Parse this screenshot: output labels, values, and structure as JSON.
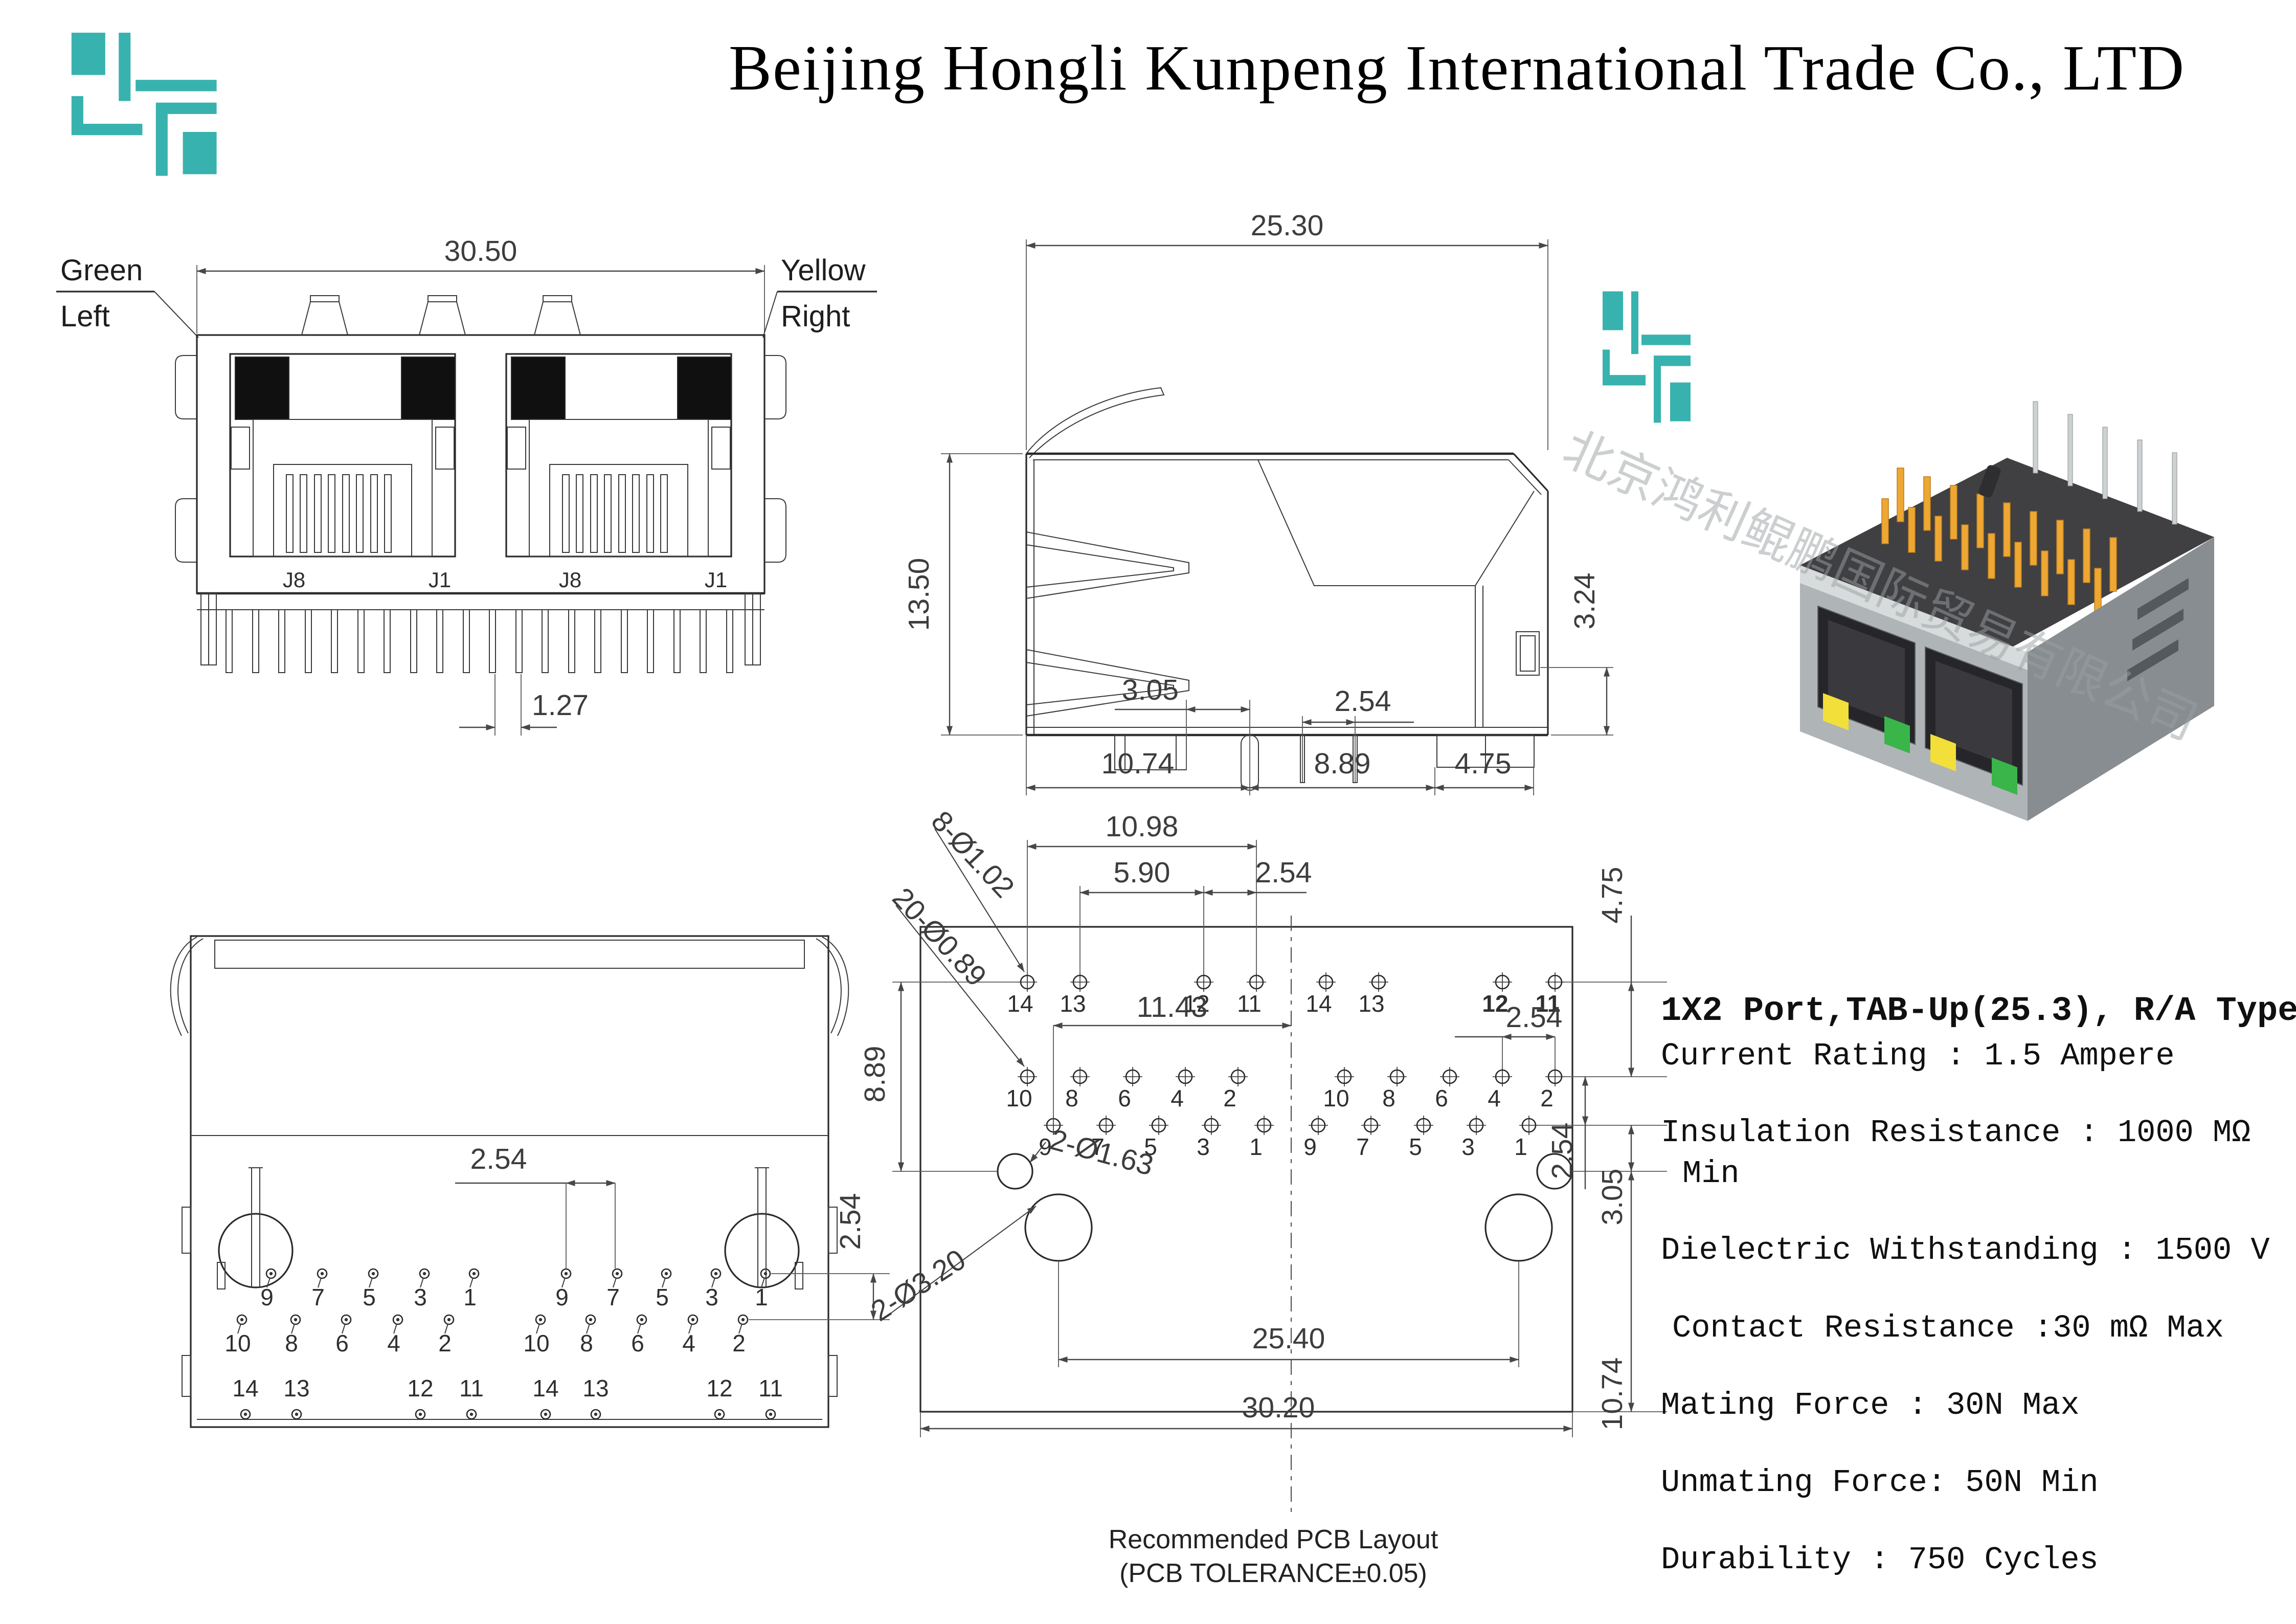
{
  "header": {
    "title": "Beijing Hongli Kunpeng International Trade Co., LTD"
  },
  "colors": {
    "brand_teal": "#38b2ae",
    "led_yellow": "#f2df3a",
    "led_green": "#3ab54a",
    "pin_gold": "#efa733"
  },
  "front_view": {
    "dim_width": "30.50",
    "dim_pitch": "1.27",
    "label_green": "Green",
    "label_left": "Left",
    "label_yellow": "Yellow",
    "label_right": "Right",
    "port_labels": [
      "J8",
      "J1",
      "J8",
      "J1"
    ]
  },
  "side_view": {
    "dim_width": "25.30",
    "dim_height": "13.50",
    "dim_tab": "3.24",
    "dim_305": "3.05",
    "dim_254": "2.54",
    "dim_1074": "10.74",
    "dim_889": "8.89",
    "dim_475": "4.75"
  },
  "bottom_view": {
    "dim_h": "2.54",
    "dim_v": "2.54",
    "row_odd": [
      "9",
      "7",
      "5",
      "3",
      "1",
      "9",
      "7",
      "5",
      "3",
      "1"
    ],
    "row_even": [
      "10",
      "8",
      "6",
      "4",
      "2",
      "10",
      "8",
      "6",
      "4",
      "2"
    ],
    "row_led": [
      "14",
      "13",
      "12",
      "11",
      "14",
      "13",
      "12",
      "11"
    ]
  },
  "pcb_layout": {
    "callout_led_holes": "8-Ø1.02",
    "callout_signal_holes": "20-Ø0.89",
    "callout_small_holes": "2-Ø1.63",
    "callout_big_holes": "2-Ø3.20",
    "dim_1098": "10.98",
    "dim_590": "5.90",
    "dim_254_top": "2.54",
    "dim_1143": "11.43",
    "dim_254_mid": "2.54",
    "dim_475": "4.75",
    "dim_254_right": "2.54",
    "dim_305": "3.05",
    "dim_889": "8.89",
    "dim_1074": "10.74",
    "dim_2540": "25.40",
    "dim_3020": "30.20",
    "row_led": [
      "14",
      "13",
      "12",
      "11",
      "14",
      "13",
      "12",
      "11"
    ],
    "row_even": [
      "10",
      "8",
      "6",
      "4",
      "2",
      "10",
      "8",
      "6",
      "4",
      "2"
    ],
    "row_odd": [
      "9",
      "7",
      "5",
      "3",
      "1",
      "9",
      "7",
      "5",
      "3",
      "1"
    ],
    "caption_line1": "Recommended PCB Layout",
    "caption_line2": "(PCB TOLERANCE±0.05)"
  },
  "photo": {
    "watermark": "北京鸿利鲲鹏国际贸易有限公司"
  },
  "specs": {
    "model": "1X2 Port,TAB-Up(25.3), R/A Type",
    "lines": [
      "Current Rating : 1.5 Ampere",
      "Insulation Resistance : 1000 MΩ",
      "Min",
      "Dielectric Withstanding : 1500 V",
      "Contact Resistance :30 mΩ Max",
      "Mating Force : 30N Max",
      "Unmating Force: 50N Min",
      "Durability : 750 Cycles"
    ]
  }
}
